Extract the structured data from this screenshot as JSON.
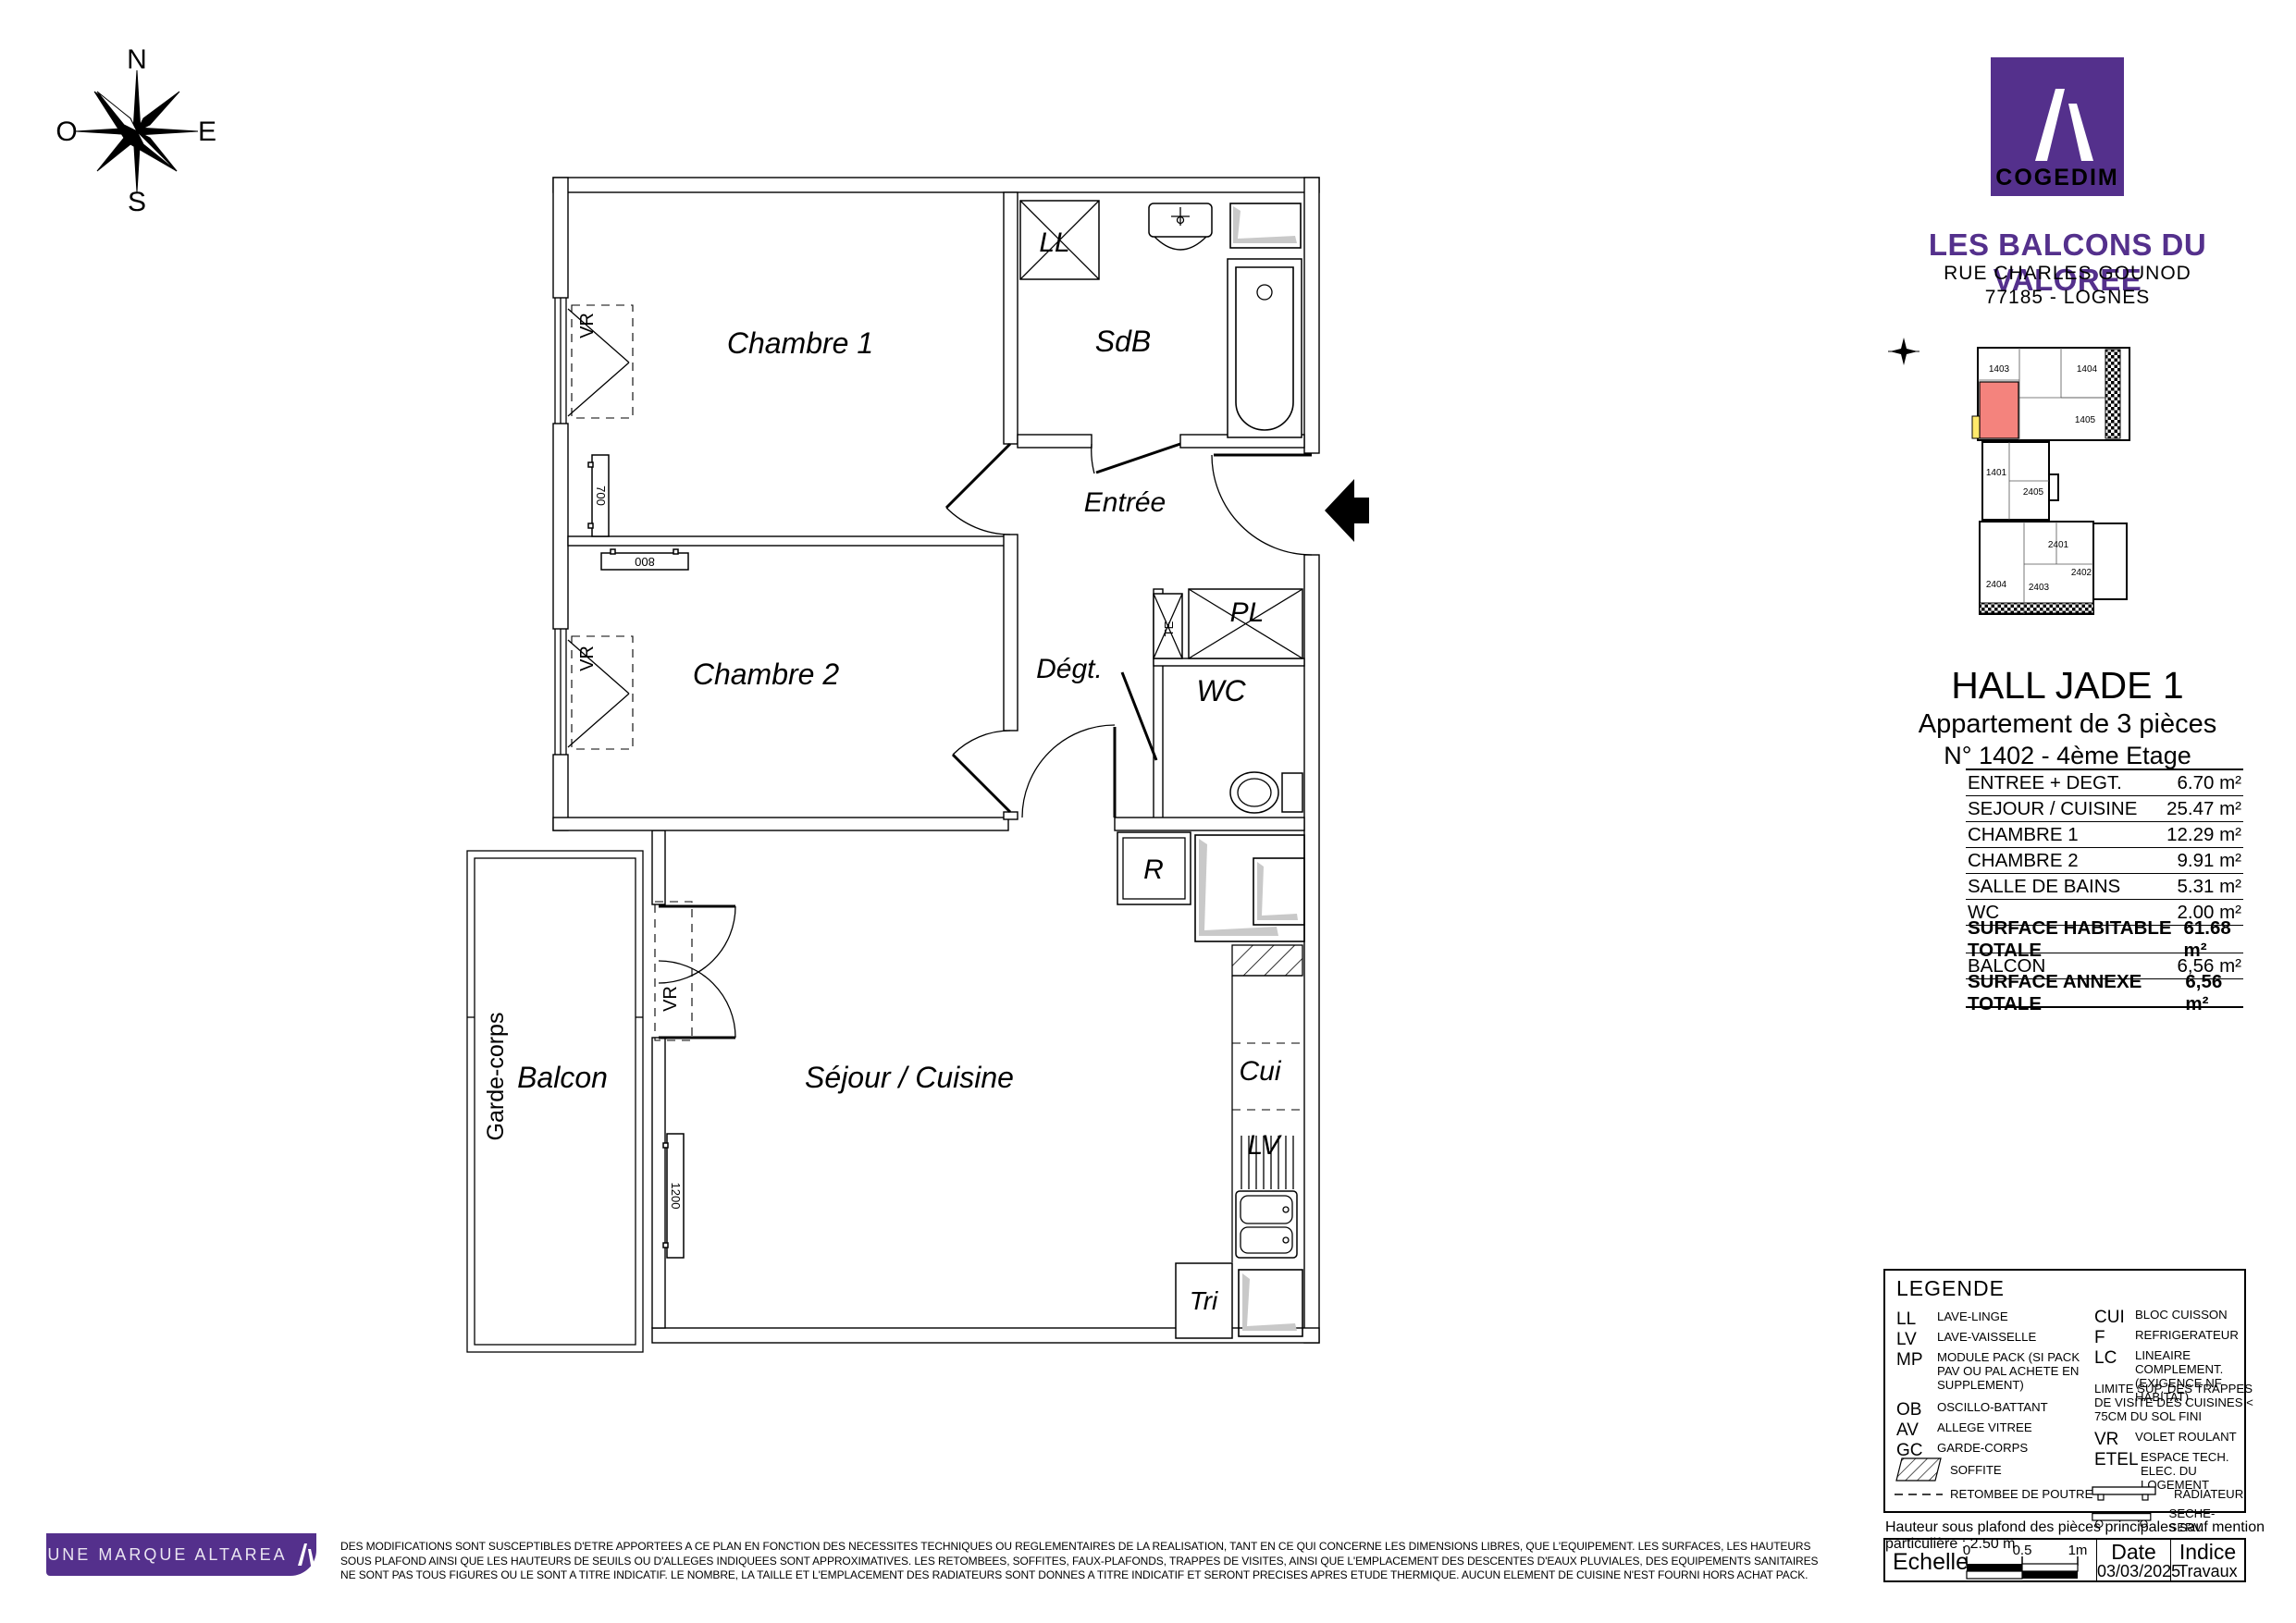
{
  "colors": {
    "purple": "#54308c",
    "highlight_unit": "#f4837d",
    "balcony_yellow": "#ffe96b",
    "soffit_gray": "#c9c9c9"
  },
  "compass": {
    "n": "N",
    "e": "E",
    "s": "S",
    "o": "O"
  },
  "plan": {
    "rooms": {
      "chambre1": "Chambre 1",
      "sdb": "SdB",
      "entree": "Entrée",
      "chambre2": "Chambre 2",
      "degt": "Dégt.",
      "wc": "WC",
      "sejour": "Séjour / Cuisine",
      "balcon": "Balcon"
    },
    "labels": {
      "ll": "LL",
      "pl": "PL",
      "te": "TE",
      "r": "R",
      "cui": "Cui",
      "lv": "LV",
      "tri": "Tri",
      "vr1": "VR",
      "vr2": "VR",
      "vr3": "VR",
      "garde_corps": "Garde-corps",
      "unit": "N°1402"
    },
    "dims": {
      "rad1": "700",
      "rad2": "800",
      "rad3": "1200"
    }
  },
  "header": {
    "logo_text": "COGEDIM",
    "project_title": "LES BALCONS DU VALOREE",
    "address_line1": "RUE CHARLES GOUNOD",
    "address_line2": "77185 - LOGNES"
  },
  "locator": {
    "units": [
      "1403",
      "1404",
      "1405",
      "1401",
      "2405",
      "2401",
      "2402",
      "2404",
      "2403"
    ],
    "highlighted_unit": "1402"
  },
  "apartment": {
    "hall": "HALL JADE 1",
    "type": "Appartement de 3 pièces",
    "unit_line": "N° 1402 - 4ème Etage"
  },
  "surface_table": {
    "rows": [
      {
        "label": "ENTREE + DEGT.",
        "value": "6.70 m²"
      },
      {
        "label": "SEJOUR / CUISINE",
        "value": "25.47 m²"
      },
      {
        "label": "CHAMBRE 1",
        "value": "12.29 m²"
      },
      {
        "label": "CHAMBRE 2",
        "value": "9.91 m²"
      },
      {
        "label": "SALLE DE BAINS",
        "value": "5.31 m²"
      },
      {
        "label": "WC",
        "value": "2.00 m²"
      },
      {
        "label": "SURFACE HABITABLE TOTALE",
        "value": "61.68 m²"
      },
      {
        "label": "BALCON",
        "value": "6,56 m²"
      },
      {
        "label": "SURFACE ANNEXE TOTALE",
        "value": "6,56 m²"
      }
    ]
  },
  "legend": {
    "title": "LEGENDE",
    "left": [
      {
        "abbr": "LL",
        "desc": "LAVE-LINGE"
      },
      {
        "abbr": "LV",
        "desc": "LAVE-VAISSELLE"
      },
      {
        "abbr": "MP",
        "desc": "MODULE PACK (SI PACK PAV OU PAL ACHETE EN SUPPLEMENT)"
      },
      {
        "abbr": "OB",
        "desc": "OSCILLO-BATTANT"
      },
      {
        "abbr": "AV",
        "desc": "ALLEGE VITREE"
      },
      {
        "abbr": "GC",
        "desc": "GARDE-CORPS"
      }
    ],
    "symbols_left": [
      {
        "desc": "SOFFITE"
      },
      {
        "desc": "RETOMBEE DE POUTRE"
      }
    ],
    "right": [
      {
        "abbr": "CUI",
        "desc": "BLOC CUISSON"
      },
      {
        "abbr": "F",
        "desc": "REFRIGERATEUR"
      },
      {
        "abbr": "LC",
        "desc": "LINEAIRE COMPLEMENT. (EXIGENCE NF HABITAT)"
      }
    ],
    "note": "LIMITE SUP. DES TRAPPES DE VISITE DES CUISINES < 75CM DU SOL FINI",
    "right2": [
      {
        "abbr": "VR",
        "desc": "VOLET ROULANT"
      },
      {
        "abbr": "ETEL",
        "desc": "ESPACE TECH. ELEC. DU LOGEMENT"
      }
    ],
    "symbols_right": [
      {
        "desc": "RADIATEUR"
      },
      {
        "desc": "SECHE-SERV."
      }
    ]
  },
  "ceiling_note": "Hauteur sous plafond des pièces principales sauf mention particulière : 2.50 m",
  "footer": {
    "brand": "UNE MARQUE ALTAREA",
    "scale": {
      "label": "Echelle",
      "ticks": [
        "0",
        "0.5",
        "1m"
      ]
    },
    "date": {
      "label": "Date",
      "value": "03/03/2025"
    },
    "indice": {
      "label": "Indice",
      "value": "Travaux"
    },
    "disclaimer": [
      "DES MODIFICATIONS SONT SUSCEPTIBLES D'ETRE APPORTEES A CE PLAN EN FONCTION DES NECESSITES TECHNIQUES OU REGLEMENTAIRES DE LA REALISATION, TANT EN CE QUI CONCERNE LES DIMENSIONS LIBRES, QUE L'EQUIPEMENT. LES SURFACES, LES HAUTEURS",
      "SOUS PLAFOND AINSI QUE LES HAUTEURS DE SEUILS OU D'ALLEGES INDIQUEES SONT APPROXIMATIVES. LES RETOMBEES, SOFFITES, FAUX-PLAFONDS, TRAPPES DE VISITES, AINSI QUE L'EMPLACEMENT DES DESCENTES D'EAUX PLUVIALES, DES EQUIPEMENTS SANITAIRES",
      "NE SONT PAS TOUS FIGURES OU LE SONT A TITRE INDICATIF. LE NOMBRE, LA TAILLE ET L'EMPLACEMENT DES RADIATEURS SONT DONNES A TITRE INDICATIF ET SERONT PRECISES APRES ETUDE THERMIQUE. AUCUN ELEMENT DE CUISINE N'EST FOURNI HORS ACHAT PACK."
    ]
  }
}
